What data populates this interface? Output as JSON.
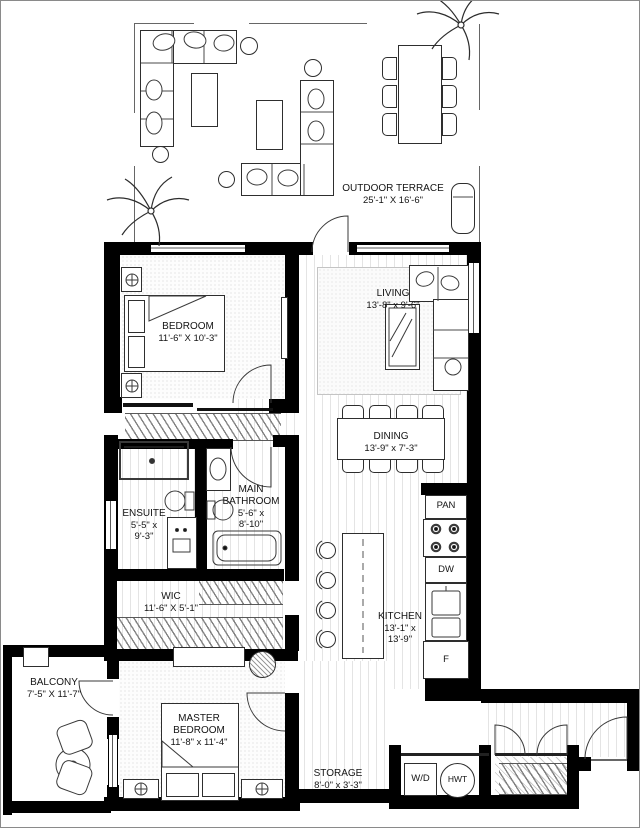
{
  "rooms": {
    "terrace": {
      "name": "OUTDOOR TERRACE",
      "dims": "25'-1\" X 16'-6\""
    },
    "bedroom": {
      "name": "BEDROOM",
      "dims": "11'-6\" X 10'-3\""
    },
    "living": {
      "name": "LIVING",
      "dims": "13'-8\" x 9'-6\""
    },
    "dining": {
      "name": "DINING",
      "dims": "13'-9\" x 7'-3\""
    },
    "main_bathroom": {
      "name": "MAIN BATHROOM",
      "dims": "5'-6\" x 8'-10\""
    },
    "ensuite": {
      "name": "ENSUITE",
      "dims": "5'-5\" x 9'-3\""
    },
    "wic": {
      "name": "WIC",
      "dims": "11'-6\" X 5'-1\""
    },
    "kitchen": {
      "name": "KITCHEN",
      "dims": "13'-1\" x 13'-9\""
    },
    "balcony": {
      "name": "BALCONY",
      "dims": "7'-5\" X 11'-7\""
    },
    "master_bedroom": {
      "name": "MASTER BEDROOM",
      "dims": "11'-8\" x 11'-4\""
    },
    "storage": {
      "name": "STORAGE",
      "dims": "8'-0\" x 3'-3\""
    }
  },
  "appliances": {
    "pantry": "PAN",
    "dishwasher": "DW",
    "fridge": "F",
    "washer_dryer": "W/D",
    "hot_water_tank": "HWT"
  },
  "colors": {
    "wall": "#000000",
    "thin_line": "#666666",
    "floor_stripe": "#e4e4e4",
    "text": "#141414"
  }
}
